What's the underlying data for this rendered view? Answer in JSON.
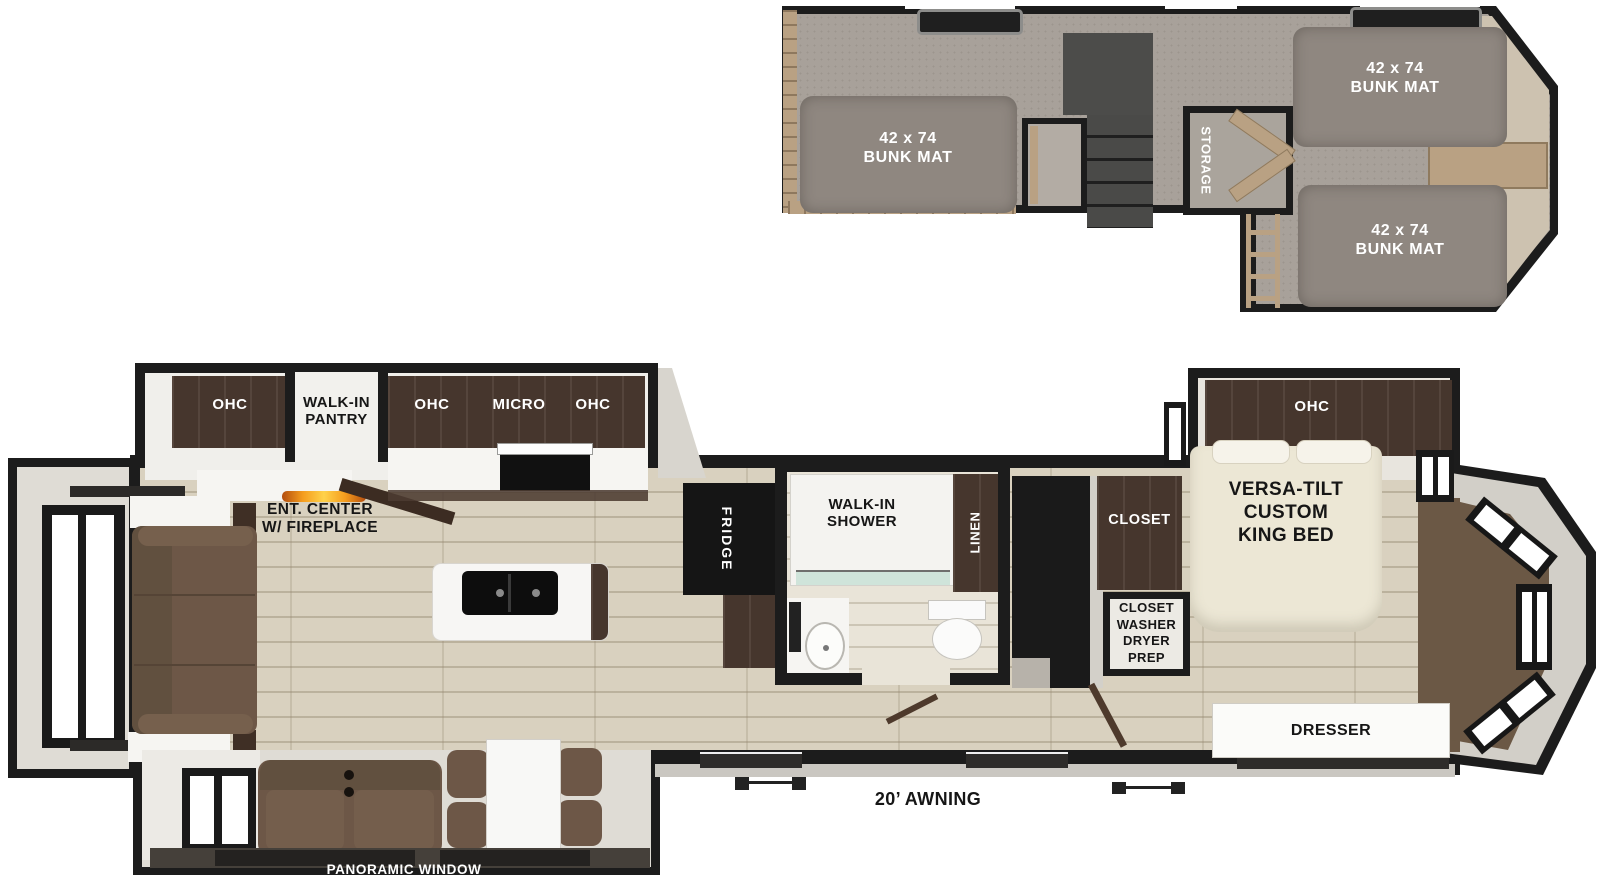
{
  "title": "RV floor plan with bunk loft",
  "loft": {
    "bunks": [
      {
        "size": "42 x 74",
        "name": "BUNK MAT"
      },
      {
        "size": "42 x 74",
        "name": "BUNK MAT"
      },
      {
        "size": "42 x 74",
        "name": "BUNK MAT"
      }
    ],
    "storage_label": "STORAGE"
  },
  "main": {
    "kitchen": {
      "ohc_left": "OHC",
      "pantry_l1": "WALK-IN",
      "pantry_l2": "PANTRY",
      "ohc_mid": "OHC",
      "micro": "MICRO",
      "ohc_right": "OHC",
      "fridge": "FRIDGE"
    },
    "living": {
      "ent_l1": "ENT. CENTER",
      "ent_l2": "W/ FIREPLACE",
      "panoramic_window": "PANORAMIC WINDOW"
    },
    "bathroom": {
      "shower_l1": "WALK-IN",
      "shower_l2": "SHOWER",
      "linen": "LINEN"
    },
    "bedroom": {
      "ohc": "OHC",
      "bed_l1": "VERSA-TILT",
      "bed_l2": "CUSTOM",
      "bed_l3": "KING BED",
      "closet": "CLOSET",
      "cwdp_l1": "CLOSET",
      "cwdp_l2": "WASHER",
      "cwdp_l3": "DRYER",
      "cwdp_l4": "PREP",
      "dresser": "DRESSER"
    },
    "exterior": {
      "awning": "20’ AWNING"
    }
  },
  "colors": {
    "wall": "#1c1c1c",
    "loft_floor": "#a8a19a",
    "bunk_mat": "#8f8780",
    "wood_floor": "#d9d1bf",
    "cabinet_brown": "#4c3b31",
    "sofa_brown": "#6d5747",
    "carpet_brown": "#6b5845",
    "flame_orange": "#f59d1e",
    "glass_teal": "#cfe4da"
  }
}
